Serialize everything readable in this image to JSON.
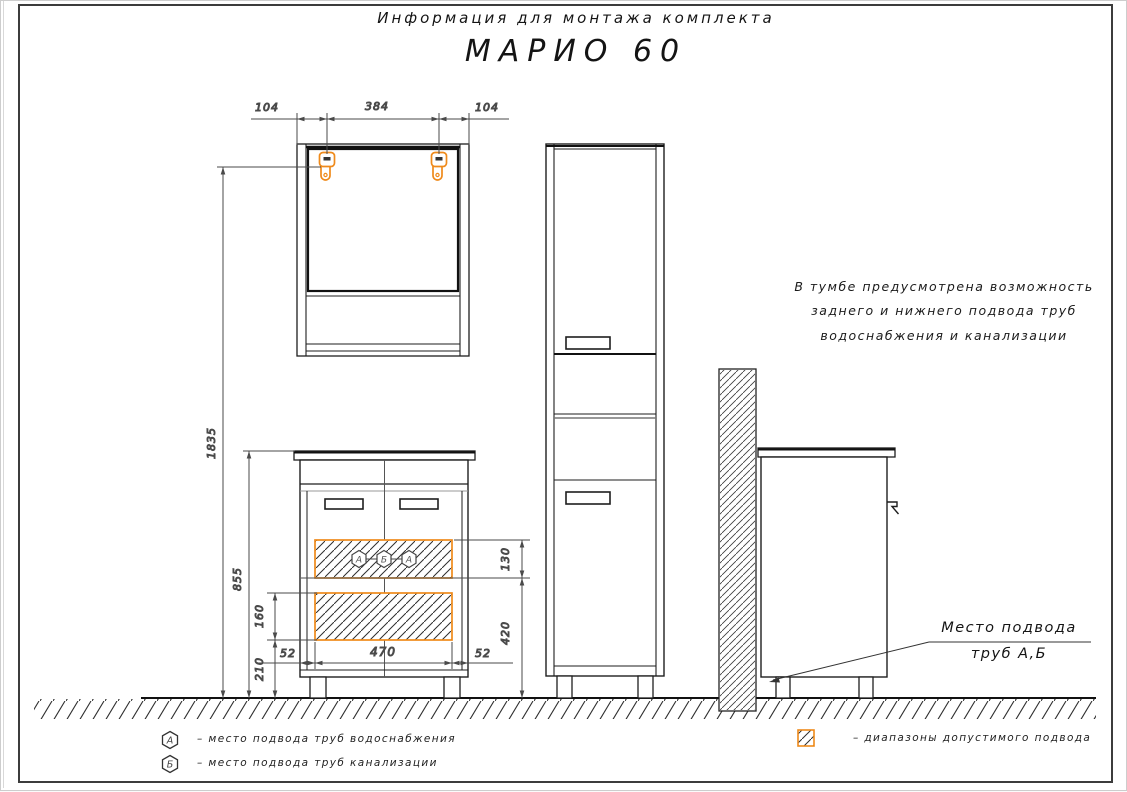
{
  "title": {
    "line1": "Информация для монтажа комплекта",
    "line2": "МАРИО 60"
  },
  "note": {
    "line1": "В тумбе предусмотрена возможность",
    "line2": "заднего и нижнего подвода труб",
    "line3": "водоснабжения и канализации"
  },
  "callout": {
    "line1": "Место подвода",
    "line2": "труб  А,Б"
  },
  "dims": {
    "mirror_left_offset": "104",
    "mirror_bracket_span": "384",
    "mirror_right_offset": "104",
    "total_height": "1835",
    "vanity_top_height": "855",
    "lower_zone_height": "160",
    "lower_zone_floor_offset": "210",
    "side_clearance_left": "52",
    "zone_width": "470",
    "side_clearance_right": "52",
    "upper_zone_height": "130",
    "upper_zone_floor_offset": "420"
  },
  "zone_markers": {
    "m1": "А",
    "m2": "Б",
    "m3": "А"
  },
  "legend": {
    "water_symbol": "А",
    "water_text": "–  место подвода труб водоснабжения",
    "sewer_symbol": "Б",
    "sewer_text": "–  место подвода труб канализации",
    "range_text": "–  диапазоны допустимого подвода"
  },
  "colors": {
    "accent_orange": "#EF8A1B",
    "line_dark": "#1e1e1e",
    "dim_gray": "#4a4a4a"
  }
}
